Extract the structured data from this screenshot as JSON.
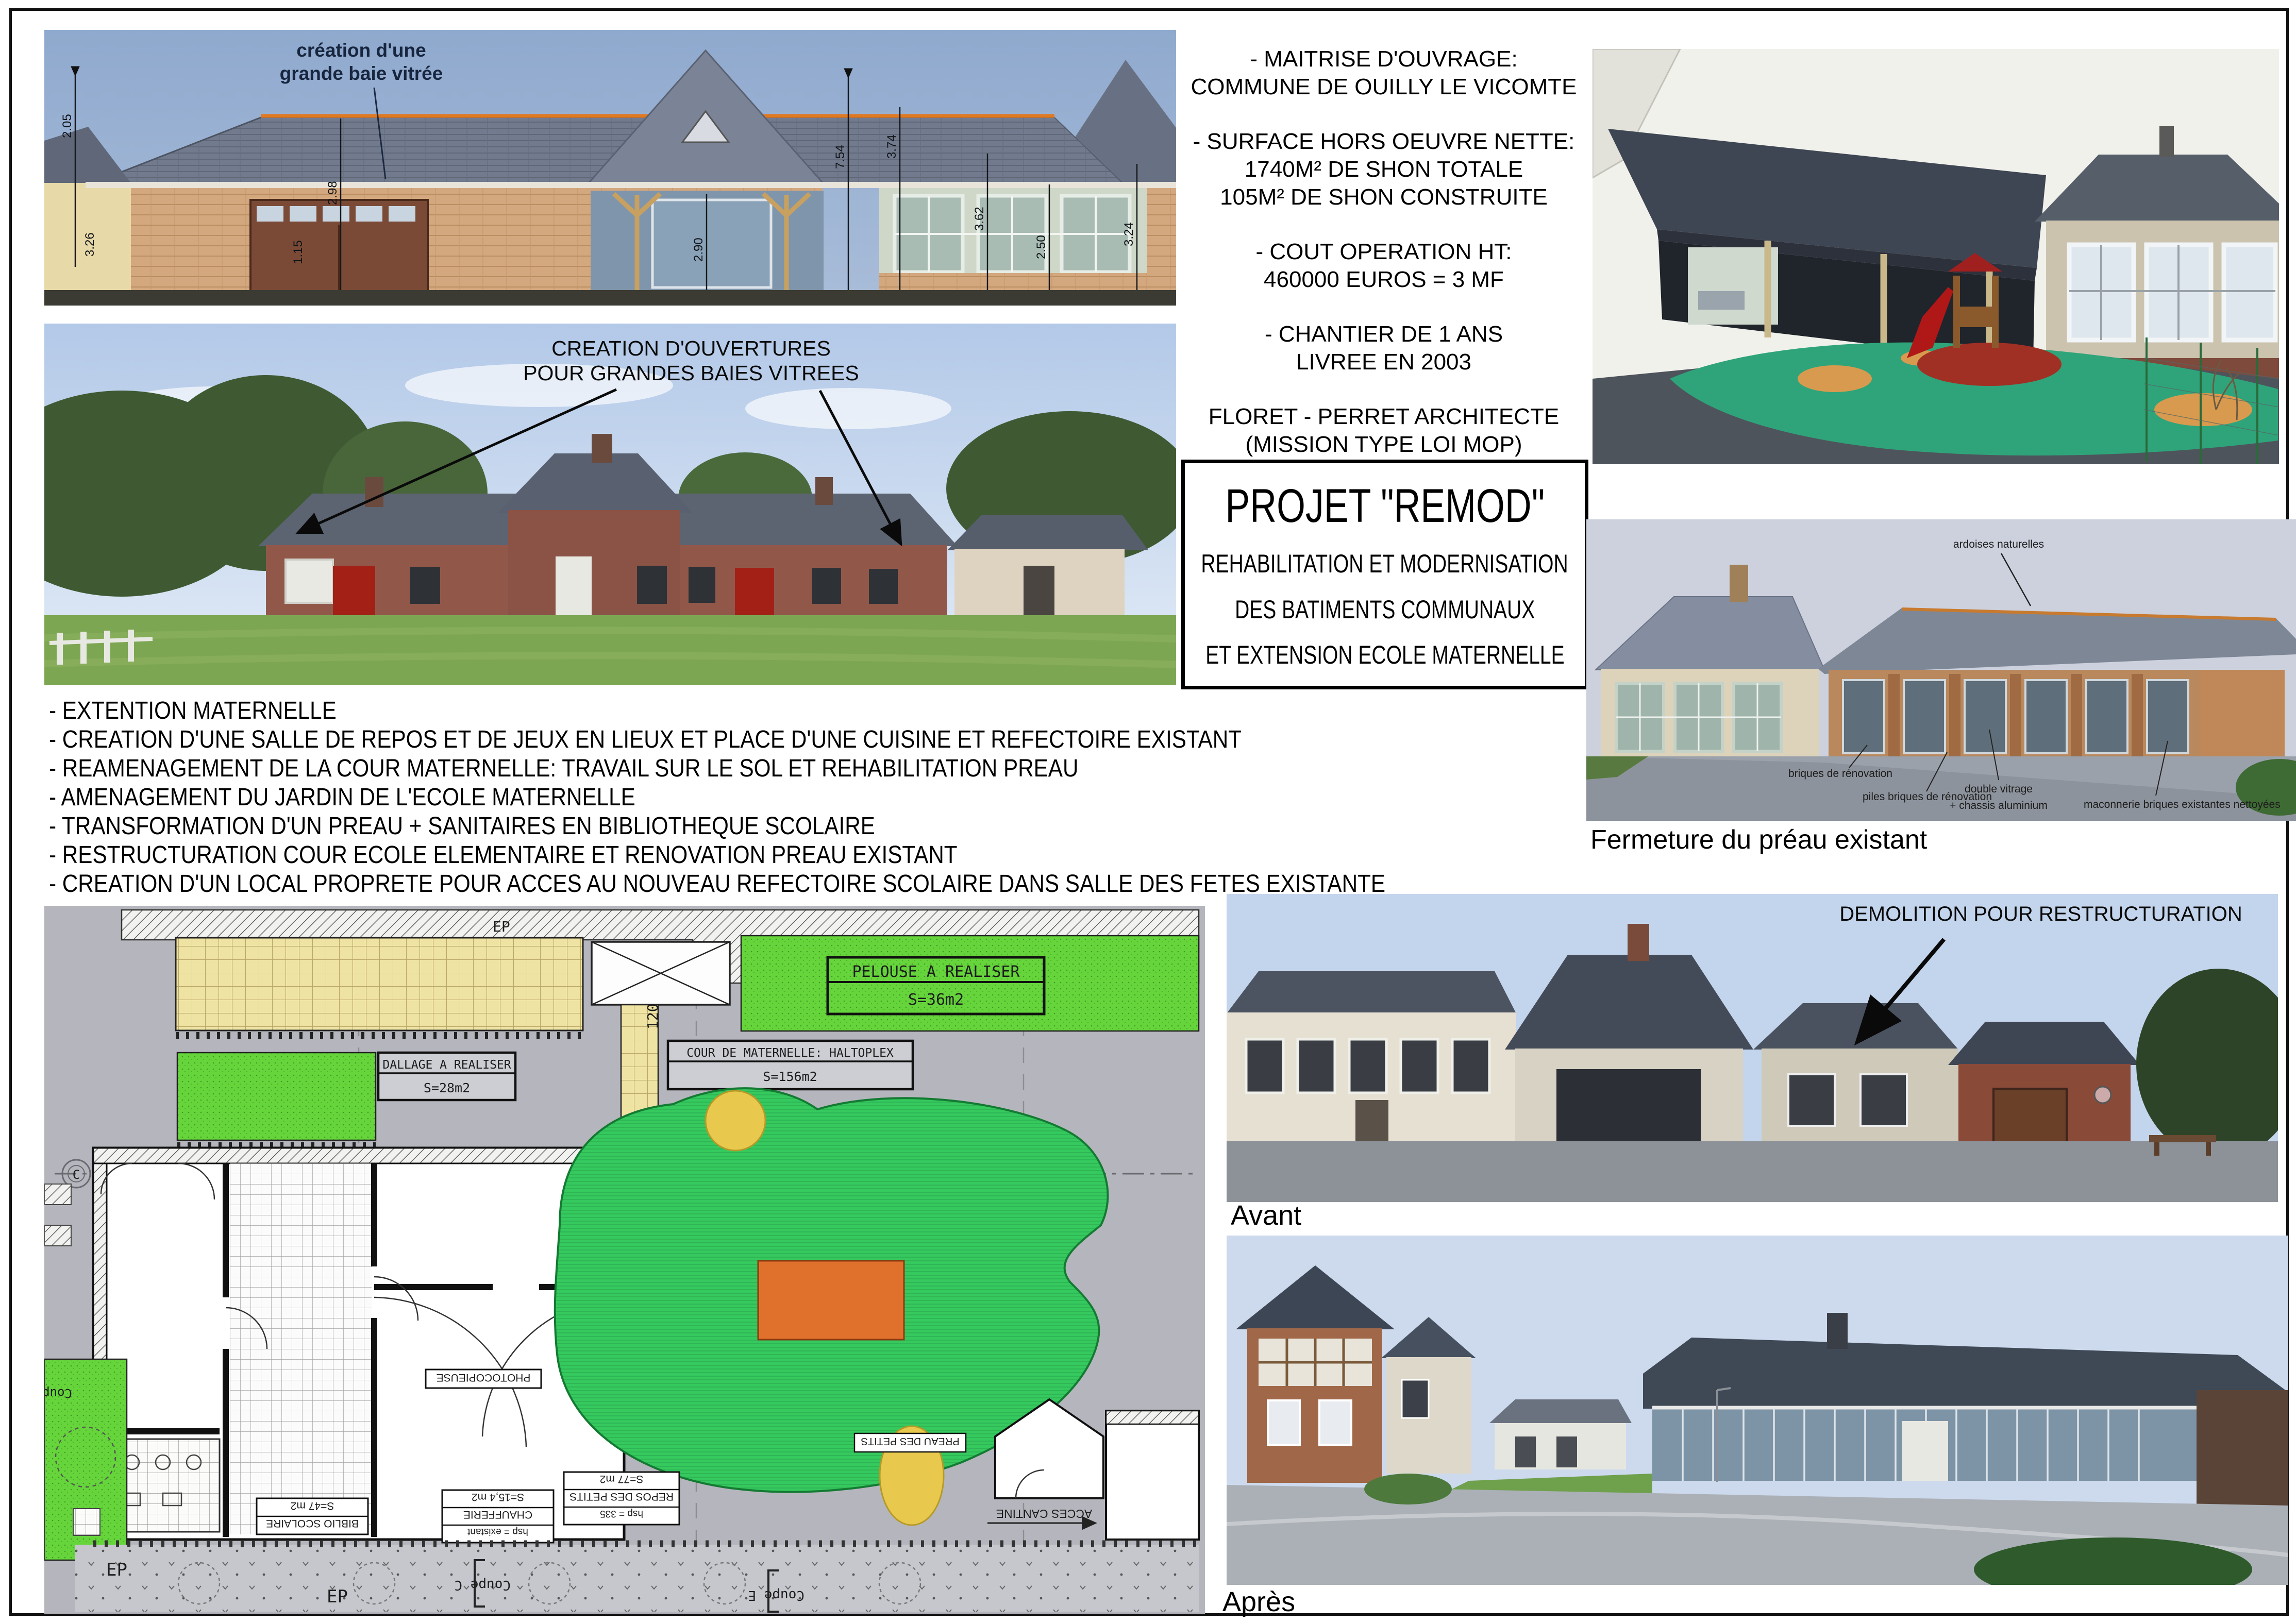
{
  "colors": {
    "accent_orange": "#e0791f",
    "plan_green": "#35c95e",
    "plan_strip_green": "#66d53c",
    "plan_yellow": "#efe3a4",
    "plan_orange": "#e0712c",
    "annotation_ink": "#17263e",
    "slate_roof": "#6f7889",
    "sky_blue": "#8fa9ce"
  },
  "info_panel": {
    "lines": [
      "- MAITRISE D'OUVRAGE:",
      "COMMUNE DE OUILLY LE VICOMTE",
      "- SURFACE HORS OEUVRE NETTE:",
      "1740M² DE SHON TOTALE",
      "105M² DE SHON CONSTRUITE",
      "- COUT OPERATION HT:",
      "460000 EUROS = 3 MF",
      "- CHANTIER DE 1 ANS",
      "LIVREE EN 2003",
      "FLORET - PERRET ARCHITECTE",
      "(MISSION TYPE LOI MOP)"
    ]
  },
  "title_box": {
    "line1": "PROJET \"REMOD\"",
    "line2": "REHABILITATION ET MODERNISATION",
    "line3": "DES BATIMENTS COMMUNAUX",
    "line4": "ET EXTENSION ECOLE MATERNELLE"
  },
  "works_list": {
    "items": [
      "- EXTENTION MATERNELLE",
      "- CREATION D'UNE SALLE DE REPOS ET DE JEUX EN LIEUX ET PLACE D'UNE CUISINE ET REFECTOIRE EXISTANT",
      "- REAMENAGEMENT DE LA COUR MATERNELLE: TRAVAIL SUR LE SOL ET REHABILITATION PREAU",
      "- AMENAGEMENT DU JARDIN DE L'ECOLE MATERNELLE",
      "- TRANSFORMATION D'UN PREAU + SANITAIRES EN BIBLIOTHEQUE SCOLAIRE",
      "- RESTRUCTURATION COUR ECOLE ELEMENTAIRE ET RENOVATION PREAU EXISTANT",
      "- CREATION D'UN LOCAL PROPRETE POUR ACCES AU NOUVEAU REFECTOIRE SCOLAIRE DANS SALLE DES FETES EXISTANTE"
    ]
  },
  "elevation": {
    "annotation_line1": "création d'une",
    "annotation_line2": "grande baie vitrée",
    "dims": [
      "2.05",
      "3.26",
      "2.98",
      "1.15",
      "2.90",
      "7.54",
      "3.74",
      "3.62",
      "2.50",
      "3.24"
    ]
  },
  "existing_photo": {
    "annotation_line1": "CREATION D'OUVERTURES",
    "annotation_line2": "POUR GRANDES BAIES VITREES"
  },
  "rendering": {
    "caption": "Fermeture du préau existant",
    "labels": {
      "roof": "ardoises naturelles",
      "brick": "briques de rénovation",
      "piers": "piles briques de rénovation",
      "glazing1": "double vitrage",
      "glazing2": "+ chassis aluminium",
      "masonry": "maconnerie briques existantes nettoyées"
    }
  },
  "avant": {
    "annotation": "DEMOLITION POUR RESTRUCTURATION",
    "caption": "Avant"
  },
  "apres": {
    "caption": "Après"
  },
  "site_plan": {
    "labels": {
      "pelouse": "PELOUSE A REALISER",
      "pelouse_area": "S=36m2",
      "dallage": "DALLAGE A REALISER",
      "dallage_area": "S=28m2",
      "cour": "COUR DE MATERNELLE: HALTOPLEX",
      "cour_area": "S=156m2",
      "dim_120": "120",
      "ep": "EP",
      "repos_h": "hsp = 335",
      "repos": "REPOS DES PETITS",
      "repos_area": "S=77 m2",
      "biblio": "BIBLIO SCOLAIRE",
      "biblio_area": "S=47 m2",
      "chaufferie_h": "hsp = existant",
      "chaufferie": "CHAUFFERIE",
      "chaufferie_area": "S=15,4 m2",
      "photocopieuse": "PHOTOCOPIEUSE",
      "preau_petits": "PREAU DES PETITS",
      "acces_cantine": "ACCES CANTINE",
      "coupe_c": "Coupe C",
      "coupe_e": "Coupe E",
      "coupe": "Coupe",
      "axis_marker": "C"
    }
  }
}
